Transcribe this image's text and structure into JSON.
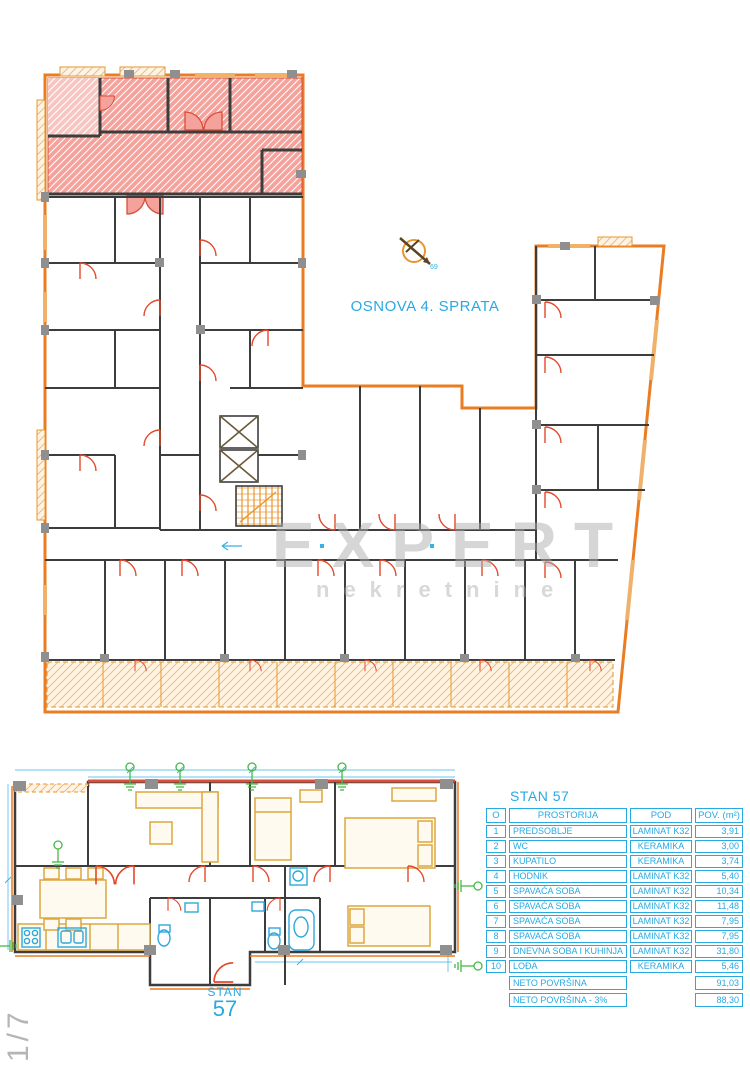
{
  "floor_plan": {
    "title": "OSNOVA 4. SPRATA",
    "compass_label": "69"
  },
  "watermark": {
    "line1": "EXPERT",
    "line2": "nekretnine"
  },
  "unit_plan": {
    "label_top": "STAN",
    "label_number": "57",
    "sheet_ref": "1/7"
  },
  "table": {
    "title": "STAN 57",
    "headers": {
      "num": "O",
      "room": "PROSTORIJA",
      "floor": "POD",
      "area": "POV. (m²)"
    },
    "rows": [
      {
        "num": "1",
        "room": "PREDSOBLJE",
        "floor": "LAMINAT K32",
        "area": "3,91"
      },
      {
        "num": "2",
        "room": "WC",
        "floor": "KERAMIKA",
        "area": "3,00"
      },
      {
        "num": "3",
        "room": "KUPATILO",
        "floor": "KERAMIKA",
        "area": "3,74"
      },
      {
        "num": "4",
        "room": "HODNIK",
        "floor": "LAMINAT K32",
        "area": "5,40"
      },
      {
        "num": "5",
        "room": "SPAVAĆA SOBA",
        "floor": "LAMINAT K32",
        "area": "10,34"
      },
      {
        "num": "6",
        "room": "SPAVAĆA SOBA",
        "floor": "LAMINAT K32",
        "area": "11,48"
      },
      {
        "num": "7",
        "room": "SPAVAĆA SOBA",
        "floor": "LAMINAT K32",
        "area": "7,95"
      },
      {
        "num": "8",
        "room": "SPAVAĆA SOBA",
        "floor": "LAMINAT K32",
        "area": "7,95"
      },
      {
        "num": "9",
        "room": "DNEVNA SOBA I KUHINJA",
        "floor": "LAMINAT K32",
        "area": "31,80"
      },
      {
        "num": "10",
        "room": "LOĐA",
        "floor": "KERAMIKA",
        "area": "5,46"
      }
    ],
    "summary": [
      {
        "label": "NETO POVRŠINA",
        "value": "91,03"
      },
      {
        "label": "NETO POVRŠINA - 3%",
        "value": "88,30"
      }
    ]
  },
  "colors": {
    "accent_cyan": "#29a9e1",
    "wall_dark": "#3d3d3d",
    "exterior_orange": "#ea7c22",
    "door_red": "#e3472a",
    "highlight_pink": "#f4a29b",
    "furniture_gold": "#dca73f",
    "fixture_blue": "#2fa8dc",
    "vent_green": "#46b946",
    "watermark_gray": "#adadad"
  }
}
